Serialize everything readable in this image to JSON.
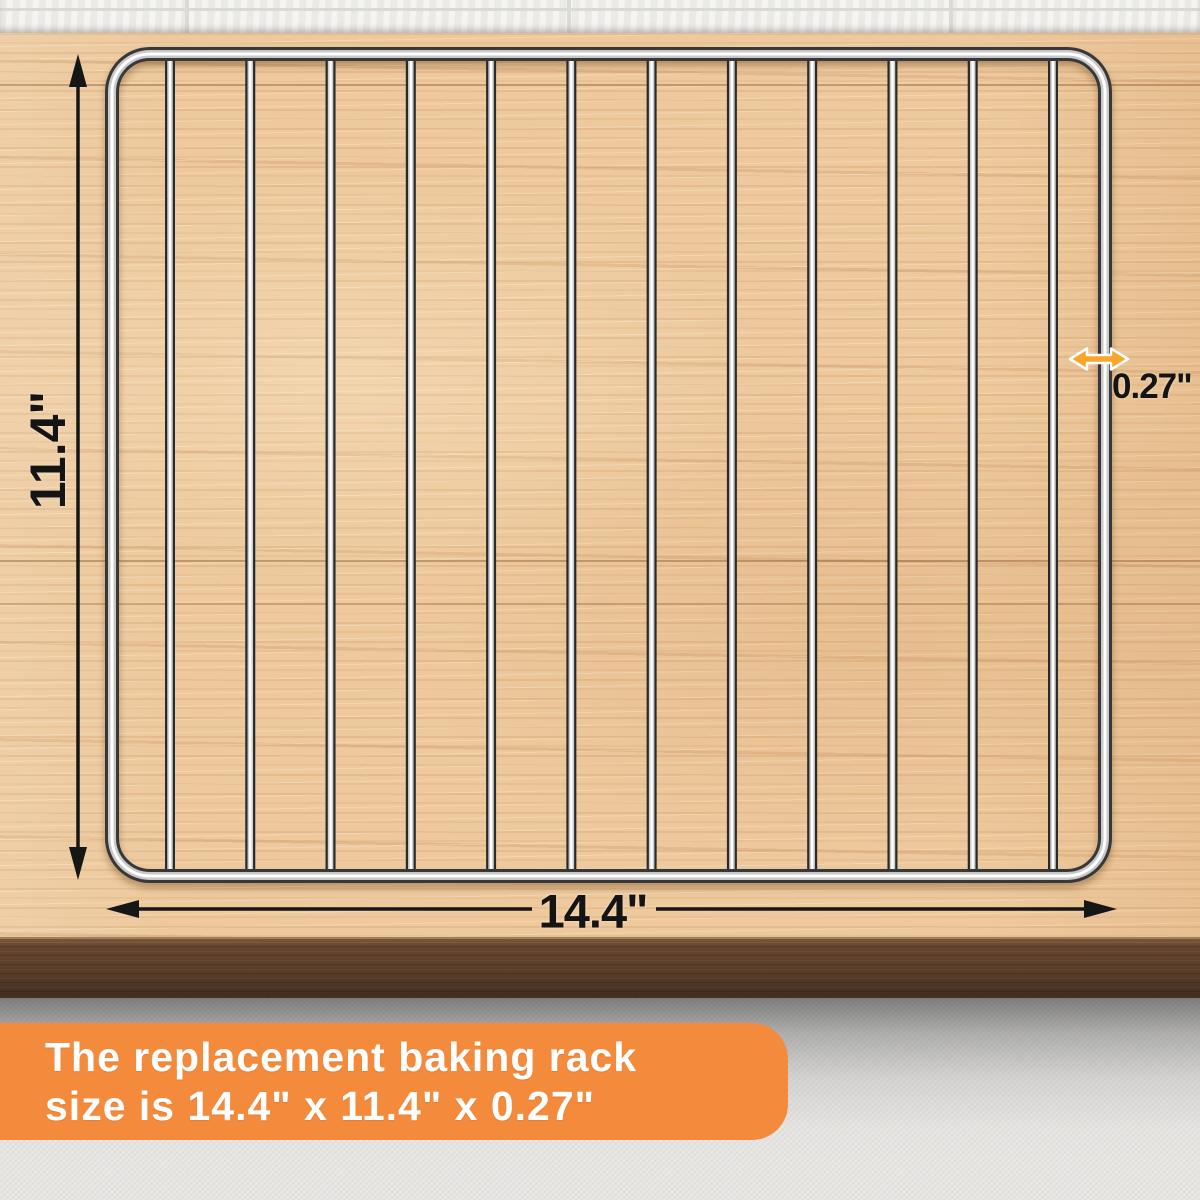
{
  "scene": {
    "dimensions": {
      "height": {
        "value": "11.4\"",
        "orientation": "vertical-left"
      },
      "width": {
        "value": "14.4\"",
        "orientation": "horizontal-bottom"
      },
      "thickness": {
        "value": "0.27\"",
        "orientation": "wire-gauge-right"
      }
    },
    "rack": {
      "wire_count": 12,
      "material": "chrome-wire",
      "description": "replacement baking rack on wooden table"
    },
    "banner": {
      "line1": "The replacement baking rack",
      "line2": "size is 14.4\" x 11.4\" x 0.27\""
    },
    "colors": {
      "banner_bg": "#f48a3b",
      "banner_text": "#ffffff",
      "dimension_arrow": "#161616",
      "thickness_arrow": "#f7a62a",
      "wood": "#edc99d",
      "table_edge": "#64452e",
      "brick_wall": "#f2f1ee"
    }
  }
}
